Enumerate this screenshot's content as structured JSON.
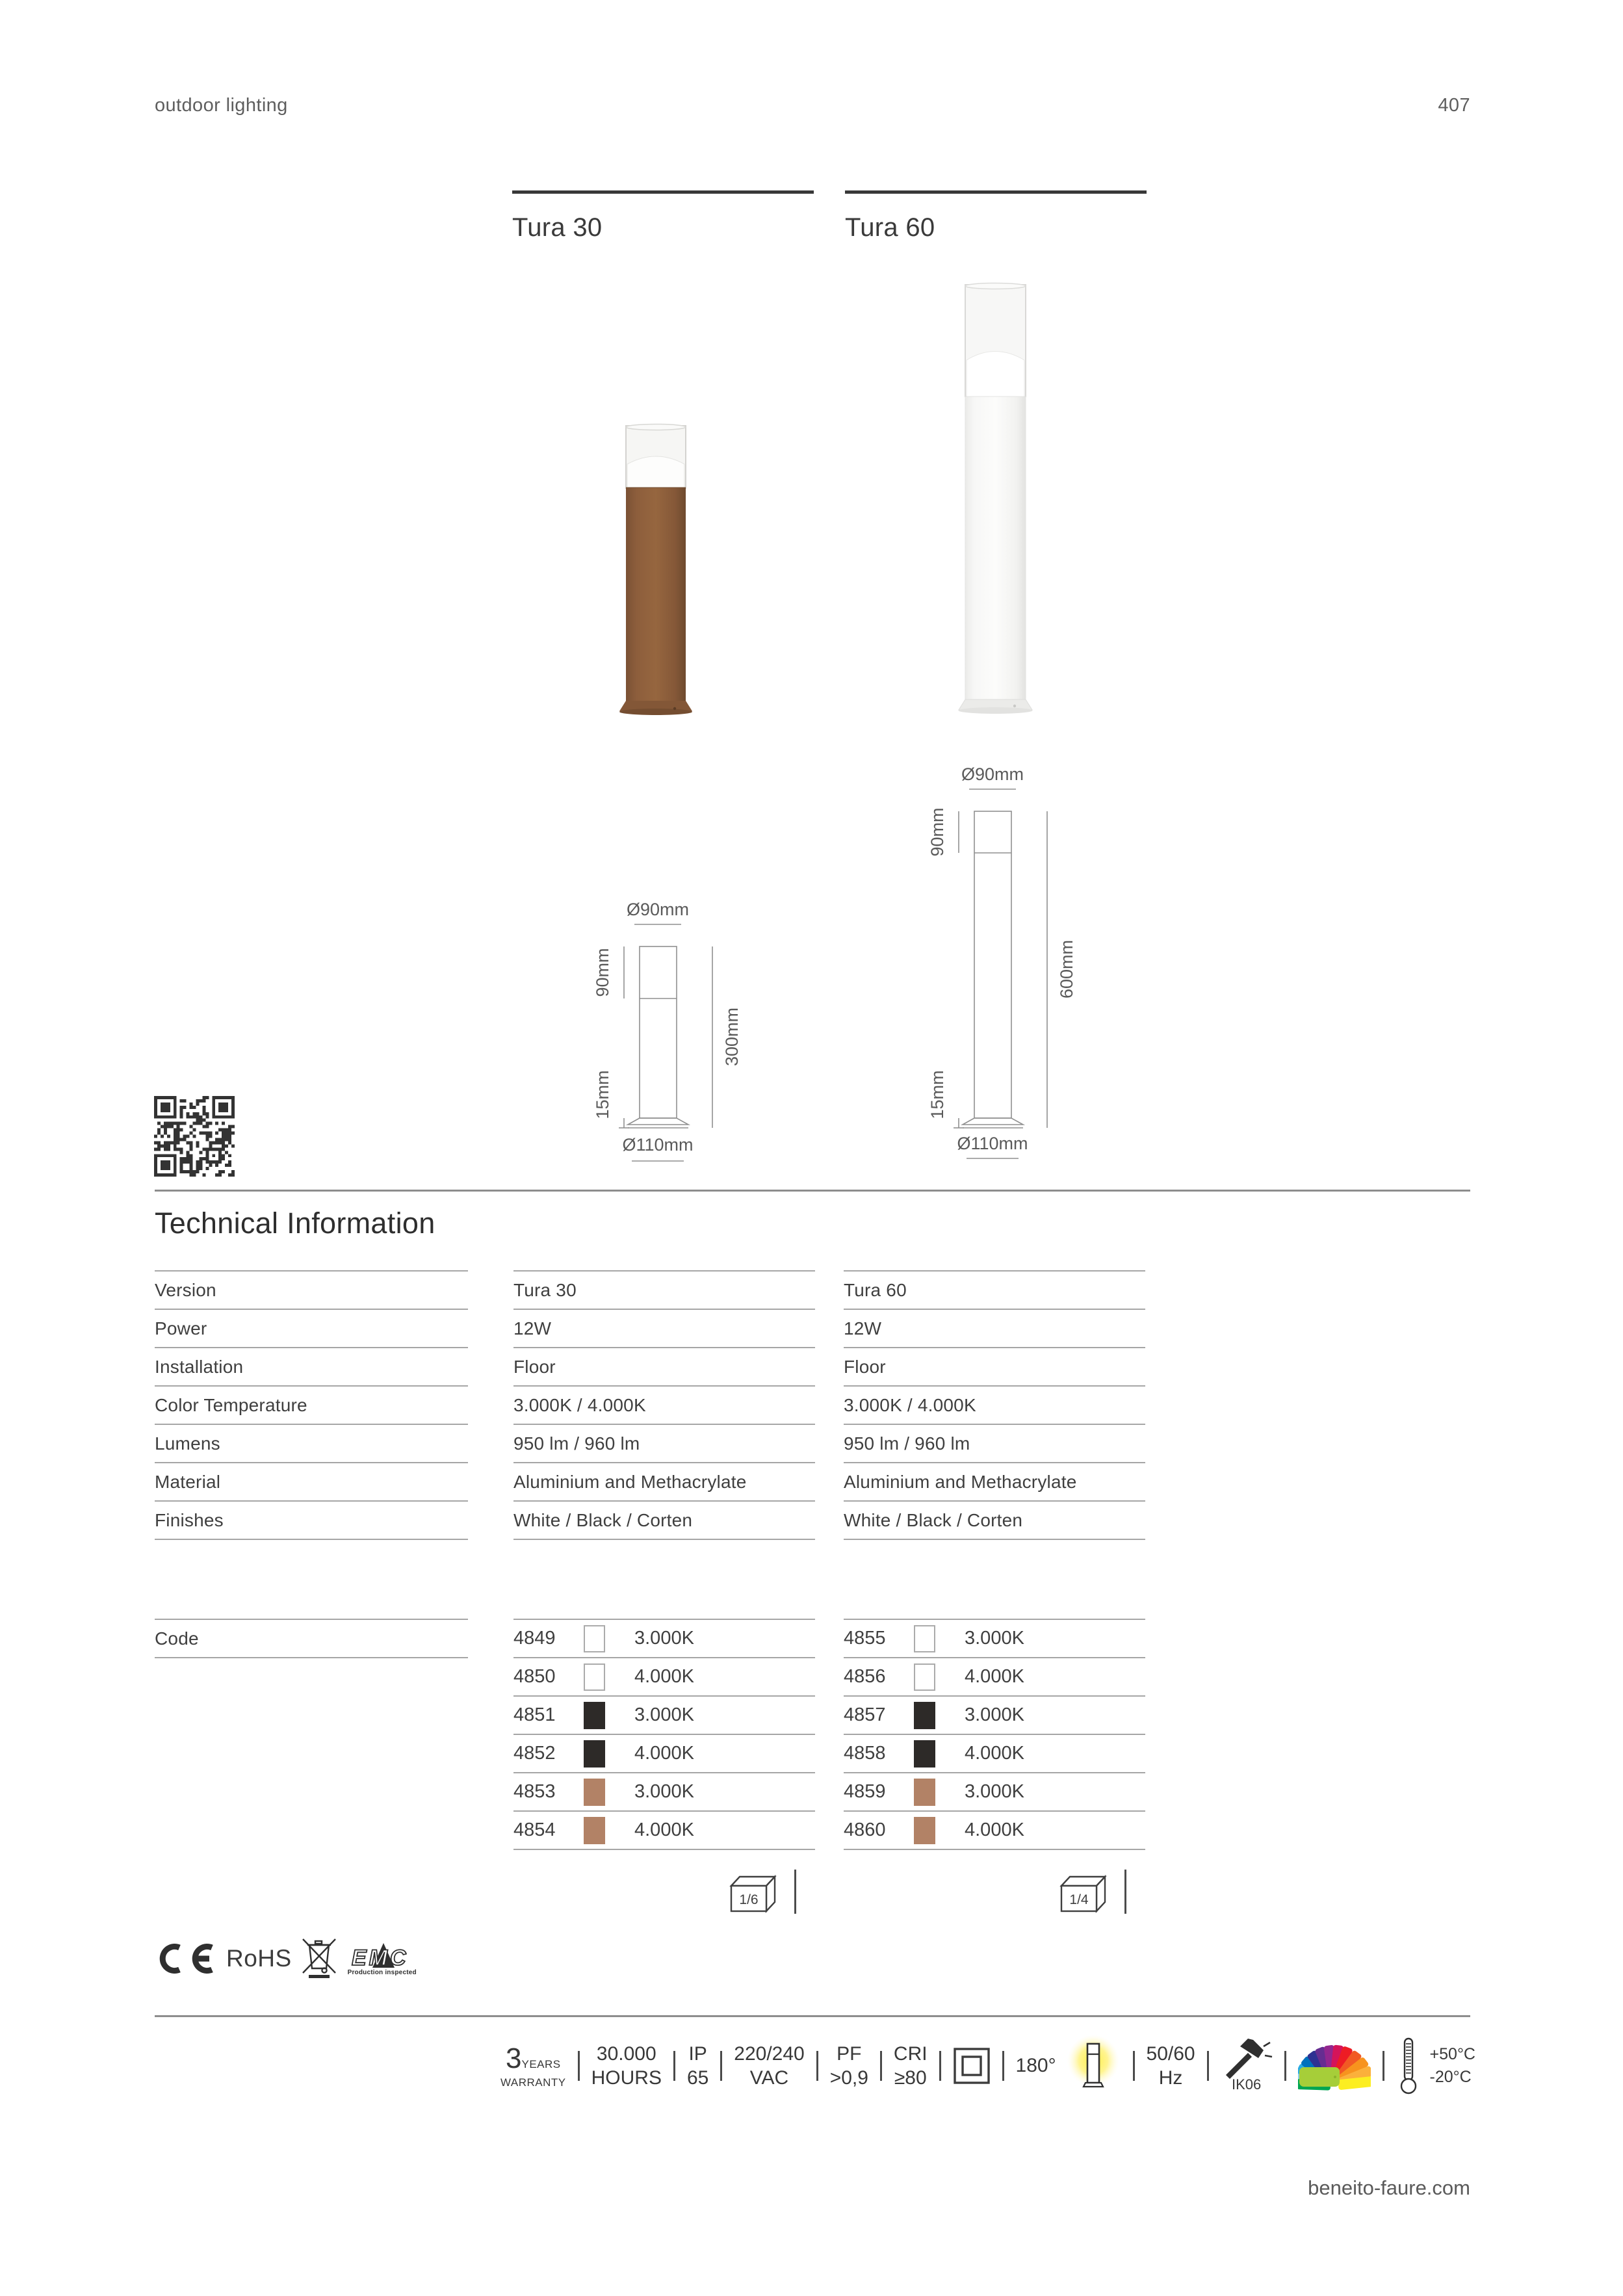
{
  "header": {
    "left": "outdoor lighting",
    "page_number": "407"
  },
  "footer": {
    "site": "beneito-faure.com"
  },
  "section": {
    "title": "Technical Information"
  },
  "products": [
    {
      "title": "Tura 30",
      "pack_ratio": "1/6",
      "finish_shown": "corten",
      "dims": {
        "top_diameter": "Ø90mm",
        "head": "90mm",
        "height": "300mm",
        "base": "15mm",
        "base_diameter": "Ø110mm"
      },
      "codes": [
        {
          "code": "4849",
          "finish": "white",
          "temp": "3.000K"
        },
        {
          "code": "4850",
          "finish": "white",
          "temp": "4.000K"
        },
        {
          "code": "4851",
          "finish": "black",
          "temp": "3.000K"
        },
        {
          "code": "4852",
          "finish": "black",
          "temp": "4.000K"
        },
        {
          "code": "4853",
          "finish": "corten",
          "temp": "3.000K"
        },
        {
          "code": "4854",
          "finish": "corten",
          "temp": "4.000K"
        }
      ]
    },
    {
      "title": "Tura 60",
      "pack_ratio": "1/4",
      "finish_shown": "white",
      "dims": {
        "top_diameter": "Ø90mm",
        "head": "90mm",
        "height": "600mm",
        "base": "15mm",
        "base_diameter": "Ø110mm"
      },
      "codes": [
        {
          "code": "4855",
          "finish": "white",
          "temp": "3.000K"
        },
        {
          "code": "4856",
          "finish": "white",
          "temp": "4.000K"
        },
        {
          "code": "4857",
          "finish": "black",
          "temp": "3.000K"
        },
        {
          "code": "4858",
          "finish": "black",
          "temp": "4.000K"
        },
        {
          "code": "4859",
          "finish": "corten",
          "temp": "3.000K"
        },
        {
          "code": "4860",
          "finish": "corten",
          "temp": "4.000K"
        }
      ]
    }
  ],
  "specs": [
    {
      "label": "Version",
      "tura30": "Tura 30",
      "tura60": "Tura 60"
    },
    {
      "label": "Power",
      "tura30": "12W",
      "tura60": "12W"
    },
    {
      "label": "Installation",
      "tura30": "Floor",
      "tura60": "Floor"
    },
    {
      "label": "Color Temperature",
      "tura30": "3.000K / 4.000K",
      "tura60": "3.000K / 4.000K"
    },
    {
      "label": "Lumens",
      "tura30": "950 lm / 960 lm",
      "tura60": "950 lm / 960 lm"
    },
    {
      "label": "Material",
      "tura30": "Aluminium and Methacrylate",
      "tura60": "Aluminium and Methacrylate"
    },
    {
      "label": "Finishes",
      "tura30": "White / Black / Corten",
      "tura60": "White / Black / Corten"
    }
  ],
  "code_row_label": "Code",
  "finish_colors": {
    "white": "#ffffff",
    "black": "#2d2a28",
    "corten": "#b28266"
  },
  "certifications": {
    "rohs": "RoHS",
    "emc": "EMC",
    "emc_sub": "Production inspected"
  },
  "badges": {
    "warranty": {
      "big": "3",
      "small": "YEARS",
      "bottom": "WARRANTY"
    },
    "hours": {
      "top": "30.000",
      "bottom": "HOURS"
    },
    "ip": {
      "top": "IP",
      "bottom": "65"
    },
    "vac": {
      "top": "220/240",
      "bottom": "VAC"
    },
    "pf": {
      "top": "PF",
      "bottom": ">0,9"
    },
    "cri": {
      "top": "CRI",
      "bottom": "≥80"
    },
    "beam": {
      "label": "180°"
    },
    "hz": {
      "top": "50/60",
      "bottom": "Hz"
    },
    "ik": {
      "label": "IK06"
    },
    "temp": {
      "top": "+50°C",
      "bottom": "-20°C"
    }
  },
  "icons": {
    "qr": "qr-code",
    "ce": "ce-mark",
    "weee": "crossed-out-wheeled-bin",
    "package": "carton-box",
    "class2": "class-ii-double-square",
    "bollard": "bollard-glow",
    "hammer": "ik-impact-hammer",
    "fan": "ral-color-fan",
    "thermometer": "operating-temperature"
  }
}
